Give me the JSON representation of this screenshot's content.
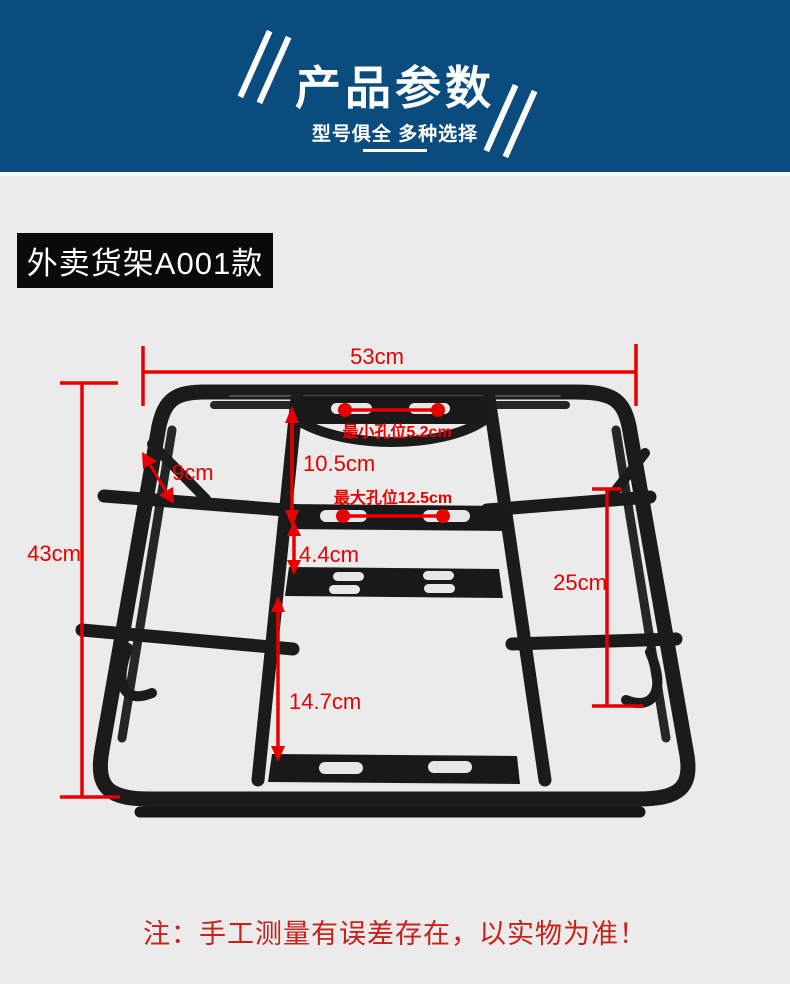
{
  "header": {
    "title": "产品参数",
    "subtitle": "型号俱全 多种选择"
  },
  "product": {
    "label": "外卖货架A001款"
  },
  "dimensions": {
    "top_width": "53cm",
    "min_hole": "最小孔位5.2cm",
    "upper_gap": "10.5cm",
    "max_hole": "最大孔位12.5cm",
    "plate_gap": "4.4cm",
    "corner_brace": "9cm",
    "left_height": "43cm",
    "right_height": "25cm",
    "lower_gap": "14.7cm"
  },
  "footer": {
    "note": "注：手工测量有误差存在，以实物为准！"
  },
  "colors": {
    "header_bg": "#0a4c7d",
    "annotation_red": "#e80000",
    "note_red": "#c8201a",
    "page_bg": "#ebebeb",
    "label_bg": "#0a0a0a"
  }
}
